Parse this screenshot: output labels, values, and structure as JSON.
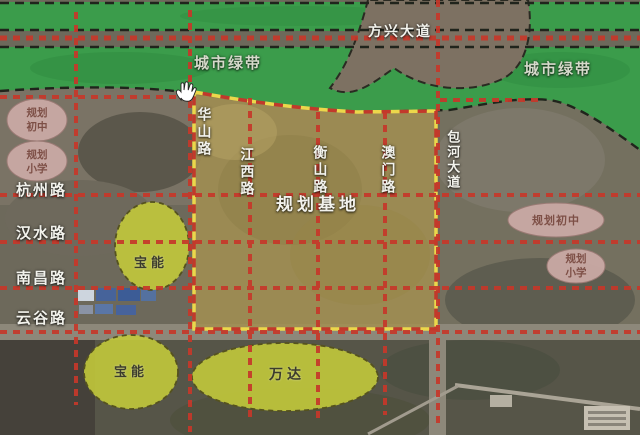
{
  "map": {
    "type": "urban-planning-satellite-map",
    "cursor_icon": "hand-grab-cursor",
    "labels": {
      "green_belt_left": "城市绿带",
      "green_belt_right": "城市绿带",
      "avenue_top": "方兴大道",
      "planning_base": "规划基地"
    },
    "roads": {
      "horizontal": [
        {
          "name": "杭州路"
        },
        {
          "name": "汉水路"
        },
        {
          "name": "南昌路"
        },
        {
          "name": "云谷路"
        }
      ],
      "vertical": [
        {
          "name": "华山路"
        },
        {
          "name": "江西路"
        },
        {
          "name": "衡山路"
        },
        {
          "name": "澳门路"
        },
        {
          "name": "包河大道"
        }
      ]
    },
    "school_zones": [
      {
        "label": "规划初中",
        "position": "left"
      },
      {
        "label": "规划小学",
        "position": "left"
      },
      {
        "label": "规划初中",
        "position": "right"
      },
      {
        "label": "规划小学",
        "position": "right"
      }
    ],
    "commercial_zones": [
      {
        "label": "宝能"
      },
      {
        "label": "宝能"
      },
      {
        "label": "万达"
      }
    ],
    "colors": {
      "green_belt": "#3b9c4b",
      "road_dash_red": "#c6382a",
      "base_fill": "#a28e52",
      "base_border_yellow": "#ecd74b",
      "commercial_zone_yellow": "#c2c93b",
      "school_zone_pink": "#c9a9a4"
    }
  }
}
